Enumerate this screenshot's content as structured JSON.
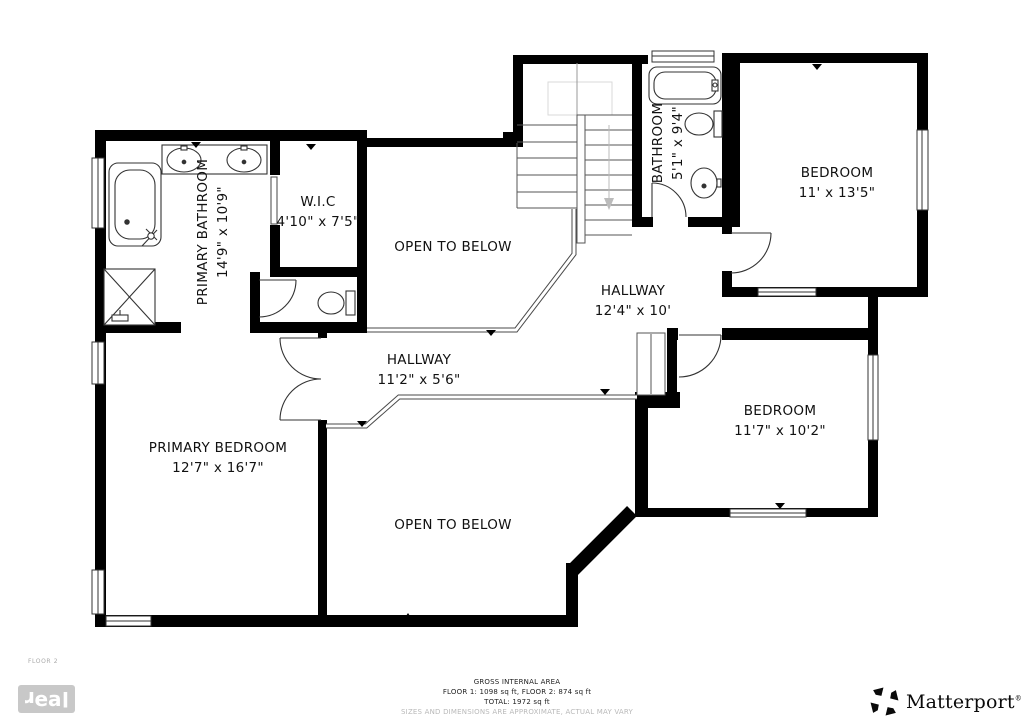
{
  "plan": {
    "floor_label": "FLOOR 2",
    "rooms": {
      "primary_bathroom": {
        "name": "PRIMARY BATHROOM",
        "dims": "14'9\" x 10'9\""
      },
      "wic": {
        "name": "W.I.C",
        "dims": "4'10\" x 7'5\""
      },
      "bathroom": {
        "name": "BATHROOM",
        "dims": "5'1\" x 9'4\""
      },
      "bedroom_top": {
        "name": "BEDROOM",
        "dims": "11' x 13'5\""
      },
      "hallway_main": {
        "name": "HALLWAY",
        "dims": "12'4\" x 10'"
      },
      "hallway_small": {
        "name": "HALLWAY",
        "dims": "11'2\" x 5'6\""
      },
      "bedroom_right": {
        "name": "BEDROOM",
        "dims": "11'7\" x 10'2\""
      },
      "primary_bedroom": {
        "name": "PRIMARY BEDROOM",
        "dims": "12'7\" x 16'7\""
      },
      "open_below_top": {
        "name": "OPEN TO BELOW"
      },
      "open_below_bottom": {
        "name": "OPEN TO BELOW"
      }
    },
    "colors": {
      "wall": "#000000",
      "fixture_line": "#333333",
      "rail_line": "#4a4a4a",
      "stair_faint": "#d9d9d9"
    }
  },
  "footer": {
    "area_title": "GROSS INTERNAL AREA",
    "area_line1": "FLOOR 1: 1098 sq ft, FLOOR 2: 874 sq ft",
    "area_line2": "TOTAL: 1972 sq ft",
    "disclaimer": "SIZES AND DIMENSIONS ARE APPROXIMATE, ACTUAL MAY VARY",
    "brand_letters": [
      "r",
      "e",
      "a",
      "l"
    ],
    "matterport": "Matterport",
    "matterport_mark": "®"
  }
}
